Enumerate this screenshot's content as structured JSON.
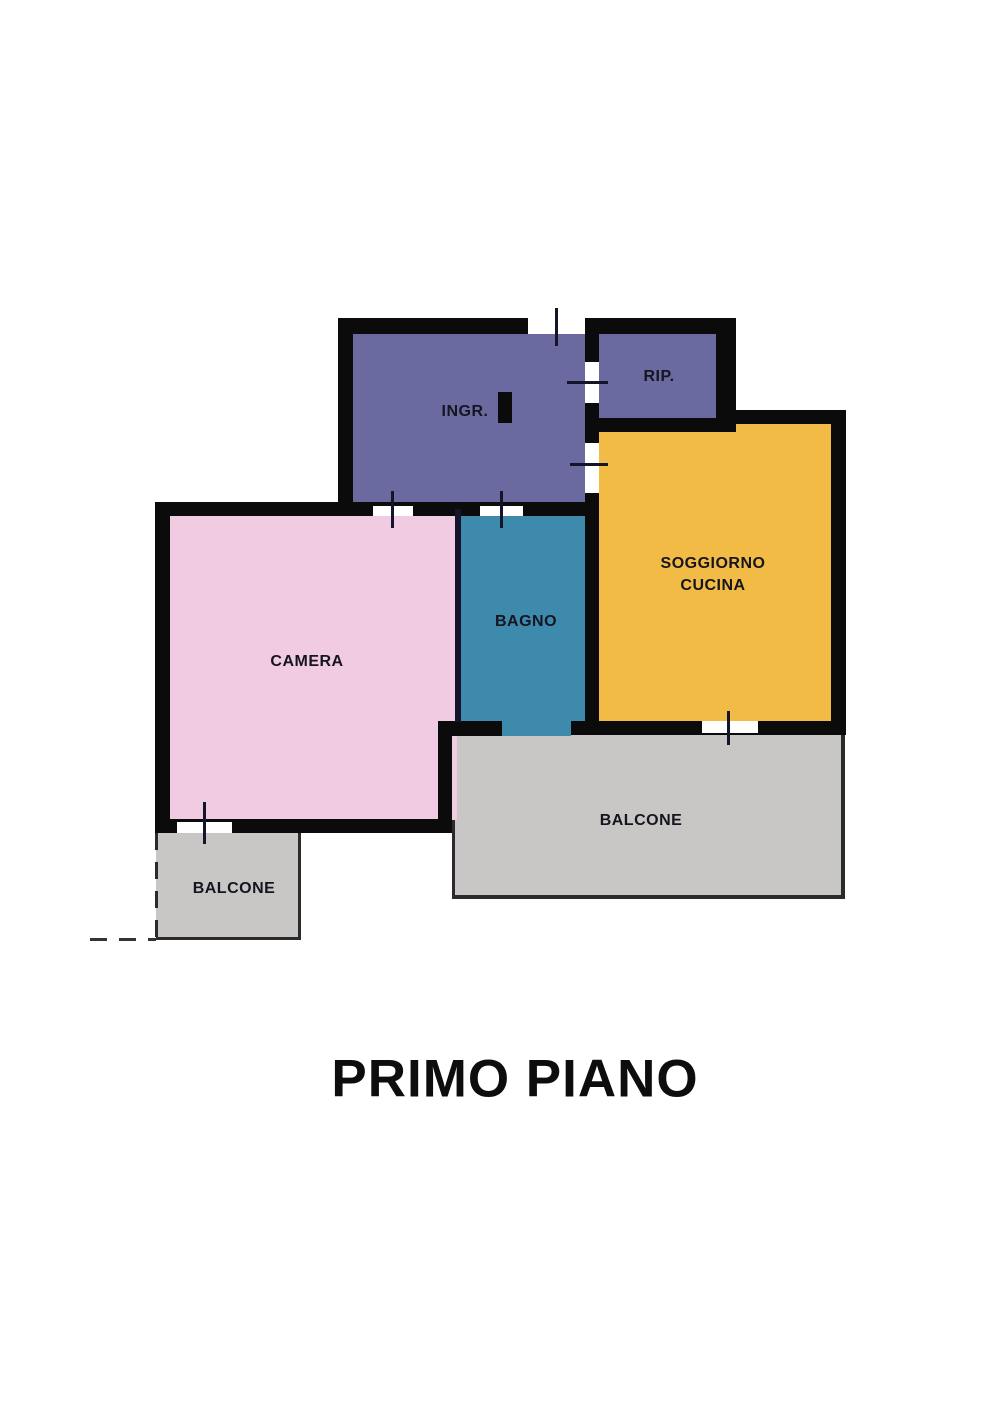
{
  "title": "PRIMO PIANO",
  "floor_plan": {
    "rooms": [
      {
        "id": "ingresso",
        "label": "INGR.",
        "color": "#6a69a0"
      },
      {
        "id": "ripostiglio",
        "label": "RIP.",
        "color": "#6a69a0"
      },
      {
        "id": "soggiorno_cucina",
        "label_lines": [
          "SOGGIORNO",
          "CUCINA"
        ],
        "color": "#f1bb45"
      },
      {
        "id": "bagno",
        "label": "BAGNO",
        "color": "#3e8aad"
      },
      {
        "id": "camera",
        "label": "CAMERA",
        "color": "#f0cbe2"
      },
      {
        "id": "balcone_camera",
        "label": "BALCONE",
        "color": "#c8c7c5"
      },
      {
        "id": "balcone_soggiorno",
        "label": "BALCONE",
        "color": "#c8c7c5"
      }
    ],
    "colors": {
      "wall": "#0b0b0b",
      "background": "#ffffff"
    }
  }
}
